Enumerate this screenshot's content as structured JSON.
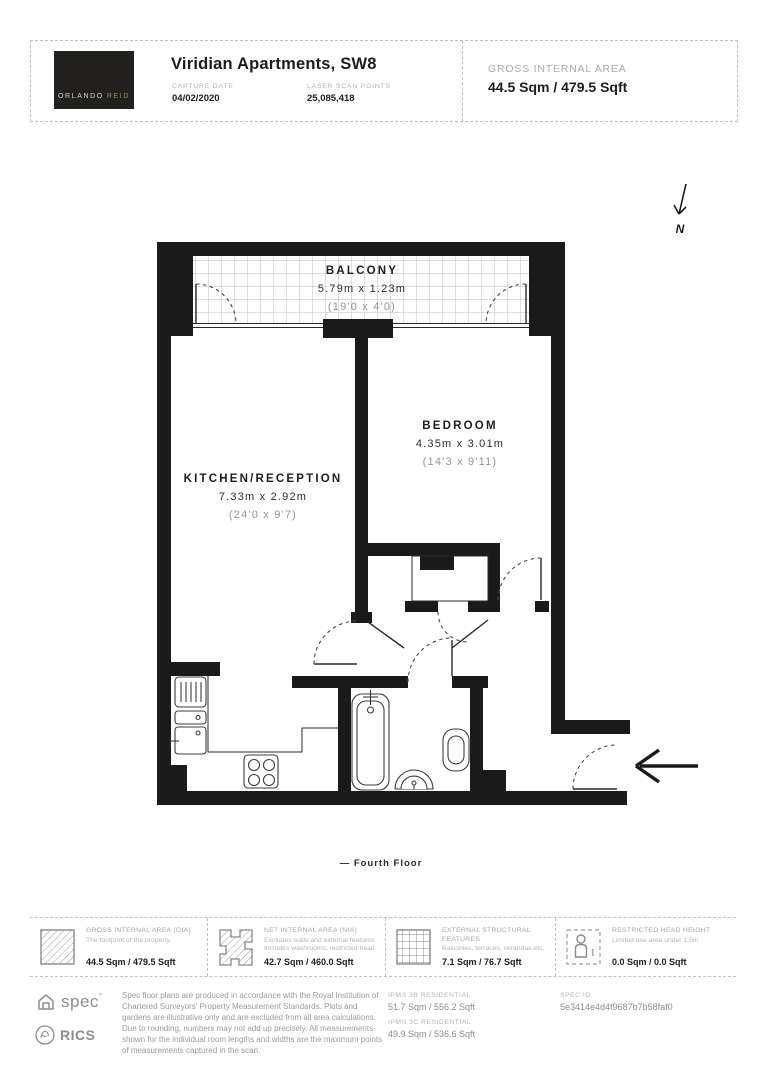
{
  "header": {
    "logo_word1": "ORLANDO",
    "logo_word2": "REID",
    "title": "Viridian Apartments, SW8",
    "capture_date_label": "CAPTURE DATE",
    "capture_date": "04/02/2020",
    "laser_scan_label": "LASER SCAN POINTS",
    "laser_scan_points": "25,085,418",
    "gia_label": "GROSS INTERNAL AREA",
    "gia_value": "44.5 Sqm / 479.5 Sqft"
  },
  "plan": {
    "north_label": "N",
    "floor_label": "— Fourth Floor",
    "rooms": {
      "balcony": {
        "name": "BALCONY",
        "metric": "5.79m x 1.23m",
        "imperial": "(19'0 x 4'0)"
      },
      "bedroom": {
        "name": "BEDROOM",
        "metric": "4.35m x 3.01m",
        "imperial": "(14'3 x 9'11)"
      },
      "kitchen_reception": {
        "name": "KITCHEN/RECEPTION",
        "metric": "7.33m x 2.92m",
        "imperial": "(24'0 x 9'7)"
      }
    }
  },
  "legend": {
    "items": [
      {
        "icon": "diagonal-hatch-square",
        "label": "GROSS INTERNAL AREA (GIA)",
        "description": "The footprint of the property.",
        "value": "44.5 Sqm / 479.5 Sqft"
      },
      {
        "icon": "hatch-floorplate",
        "label": "NET INTERNAL AREA (NIA)",
        "description": "Excludes walls and external features. Includes washrooms, restricted head",
        "value": "42.7 Sqm / 460.0 Sqft"
      },
      {
        "icon": "grid-square",
        "label": "EXTERNAL STRUCTURAL FEATURES",
        "description": "Balconies, terraces, verandas etc.",
        "value": "7.1 Sqm / 76.7 Sqft"
      },
      {
        "icon": "person-dashed-square",
        "label": "RESTRICTED HEAD HEIGHT",
        "description": "Limited use area under 1.5m",
        "value": "0.0 Sqm / 0.0 Sqft"
      }
    ]
  },
  "footer": {
    "spec_logo_text": "spec",
    "rics_logo_text": "RICS",
    "disclaimer": "Spec floor plans are produced in accordance with the Royal Institution of Chartered Surveyors' Property Measurement Standards. Plots and gardens are illustrative only and are excluded from all area calculations. Due to rounding, numbers may not add up precisely. All measurements shown for the individual room lengths and widths are the maximum points of measurements captured in the scan.",
    "ipms_3b_label": "IPMS 3B RESIDENTIAL",
    "ipms_3b_value": "51.7 Sqm / 556.2 Sqft",
    "ipms_3c_label": "IPMS 3C RESIDENTIAL",
    "ipms_3c_value": "49.9 Sqm / 536.6 Sqft",
    "spec_id_label": "SPEC ID",
    "spec_id_value": "5e3414e4d4f9687b7b58faf0"
  }
}
